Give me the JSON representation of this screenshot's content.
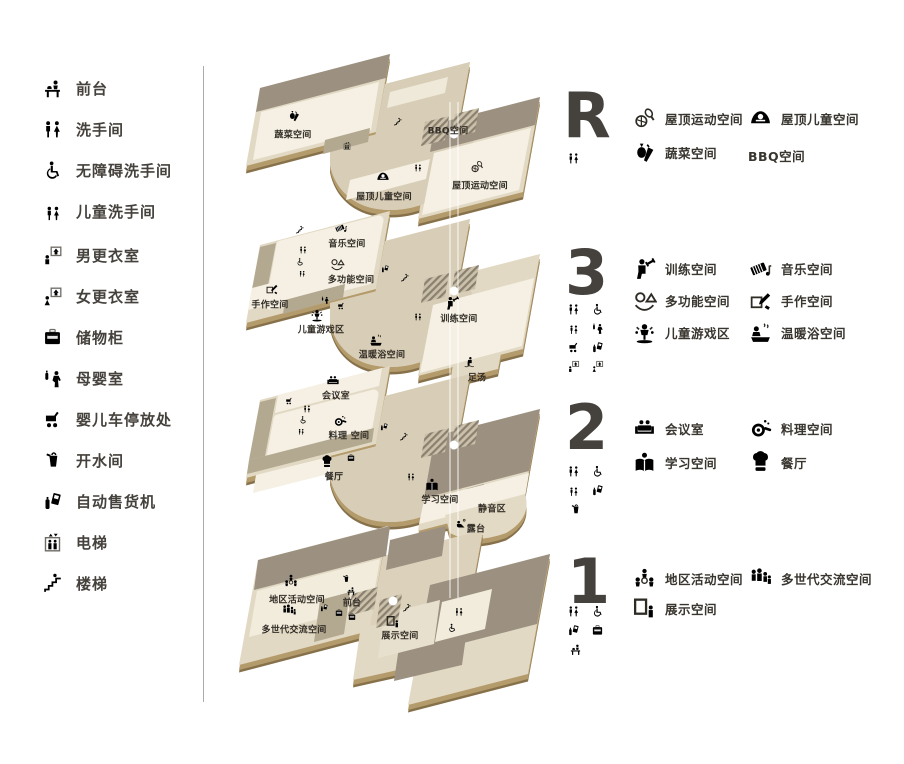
{
  "palette": {
    "plate": "#e2d9c4",
    "plate_mid": "#d8cdb6",
    "room_cream": "#f5f0e3",
    "roof_dark": "#9c9181",
    "corridor": "#b3a890",
    "edge_tan": "#b49b6c",
    "edge_dark": "#86714a",
    "text_dark": "#39352f",
    "icon_gray": "#6f6c66",
    "number_gray": "#45423e"
  },
  "legend": {
    "items": [
      {
        "icon": "reception-icon",
        "label": "前台"
      },
      {
        "icon": "restroom-icon",
        "label": "洗手间"
      },
      {
        "icon": "accessible-restroom-icon",
        "label": "无障碍洗手间"
      },
      {
        "icon": "kids-restroom-icon",
        "label": "儿童洗手间"
      },
      {
        "icon": "mens-locker-icon",
        "label": "男更衣室"
      },
      {
        "icon": "womens-locker-icon",
        "label": "女更衣室"
      },
      {
        "icon": "locker-icon",
        "label": "储物柜"
      },
      {
        "icon": "nursing-room-icon",
        "label": "母婴室"
      },
      {
        "icon": "stroller-icon",
        "label": "婴儿车停放处"
      },
      {
        "icon": "hot-water-icon",
        "label": "开水间"
      },
      {
        "icon": "vending-machine-icon",
        "label": "自动售货机"
      },
      {
        "icon": "elevator-icon",
        "label": "电梯"
      },
      {
        "icon": "stairs-icon",
        "label": "楼梯"
      }
    ]
  },
  "floors": [
    {
      "number": "R",
      "amenities": [
        "restroom"
      ],
      "facilities": [
        {
          "icon": "roof-sports-icon",
          "label": "屋顶运动空间"
        },
        {
          "icon": "roof-kids-icon",
          "label": "屋顶儿童空间"
        },
        {
          "icon": "vegetable-icon",
          "label": "蔬菜空间"
        },
        {
          "icon": null,
          "label": "BBQ空间"
        }
      ]
    },
    {
      "number": "3",
      "amenities": [
        "restroom",
        "accessible-restroom",
        "kids-restroom",
        "nursing-room",
        "stroller",
        "vending-machine",
        "mens-locker",
        "womens-locker"
      ],
      "facilities": [
        {
          "icon": "training-icon",
          "label": "训练空间"
        },
        {
          "icon": "music-icon",
          "label": "音乐空间"
        },
        {
          "icon": "multi-purpose-icon",
          "label": "多功能空间"
        },
        {
          "icon": "craft-icon",
          "label": "手作空间"
        },
        {
          "icon": "kids-play-icon",
          "label": "儿童游戏区"
        },
        {
          "icon": "bath-icon",
          "label": "温暖浴空间"
        }
      ]
    },
    {
      "number": "2",
      "amenities": [
        "restroom",
        "accessible-restroom",
        "kids-restroom",
        "vending-machine",
        "hot-water"
      ],
      "facilities": [
        {
          "icon": "meeting-icon",
          "label": "会议室"
        },
        {
          "icon": "cooking-icon",
          "label": "料理空间"
        },
        {
          "icon": "study-icon",
          "label": "学习空间"
        },
        {
          "icon": "restaurant-icon",
          "label": "餐厅"
        }
      ]
    },
    {
      "number": "1",
      "amenities": [
        "restroom",
        "accessible-restroom",
        "vending-machine",
        "locker",
        "reception"
      ],
      "facilities": [
        {
          "icon": "community-icon",
          "label": "地区活动空间"
        },
        {
          "icon": "generation-icon",
          "label": "多世代交流空间"
        },
        {
          "icon": "exhibit-icon",
          "label": "展示空间"
        }
      ]
    }
  ],
  "maps": {
    "roof": {
      "vegetable": "蔬菜空间",
      "bbq": "BBQ空间",
      "roof_sports": "屋顶运动空间",
      "roof_kids": "屋顶儿童空间"
    },
    "f3": {
      "music": "音乐空间",
      "multi": "多功能空间",
      "craft": "手作空间",
      "play": "儿童游戏区",
      "training": "训练空间",
      "bath": "温暖浴空间",
      "footbath": "足汤"
    },
    "f2": {
      "meeting": "会议室",
      "cooking": "料理 空间",
      "restaurant": "餐厅",
      "study": "学习空间",
      "quiet": "静音区",
      "terrace": "露台"
    },
    "f1": {
      "community": "地区活动空间",
      "generation": "多世代交流空间",
      "front": "前台",
      "exhibit": "展示空间"
    }
  }
}
